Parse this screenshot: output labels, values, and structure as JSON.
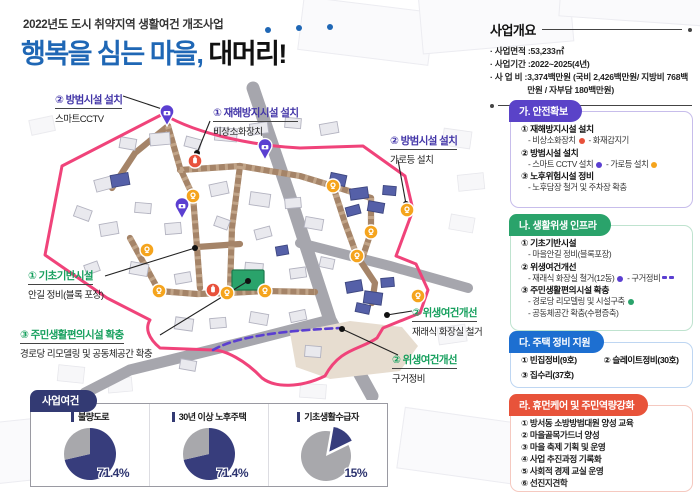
{
  "header": {
    "subtitle": "2022년도 도시 취약지역 생활여건 개조사업",
    "title_blue": "행복을 심는 마을,",
    "title_black": "대머리!"
  },
  "overview": {
    "heading": "사업개요",
    "items": [
      {
        "label": "· 사업면적 : ",
        "value": "53,233㎡"
      },
      {
        "label": "· 사업기간 : ",
        "value": "2022~2025(4년)"
      },
      {
        "label": "· 사 업 비 : ",
        "value": "3,374백만원 (국비 2,426백만원/ 지방비 768백만원 / 자부담 180백만원)"
      }
    ]
  },
  "sections": {
    "ga": {
      "title": "가. 안전확보",
      "items": [
        {
          "head": "① 재해방지시설 설치",
          "subs": [
            "- 비상소화장치",
            "- 화재감지기"
          ]
        },
        {
          "head": "② 방범시설 설치",
          "subs": [
            "- 스마트 CCTV 설치",
            "- 가로등 설치"
          ]
        },
        {
          "head": "③ 노후위험시설 정비",
          "subs": [
            "- 노후담장 철거 및 주차장 확충"
          ]
        }
      ]
    },
    "na": {
      "title": "나. 생활위생 인프라",
      "items": [
        {
          "head": "① 기초기반시설",
          "subs": [
            "- 마을안길 정비(블록포장)"
          ]
        },
        {
          "head": "② 위생여건개선",
          "subs": [
            "- 재래식 화장실 철거(12동)",
            "- 구거정비"
          ]
        },
        {
          "head": "③ 주민생활편의시설 확충",
          "subs": [
            "- 경로당 리모델링 및 시설구축",
            "- 공동체공간 확충(수평증축)"
          ]
        }
      ]
    },
    "da": {
      "title": "다. 주택 정비 지원",
      "items": [
        "① 빈집정비(9호)",
        "② 슬레이트정비(30호)",
        "③ 집수리(37호)"
      ]
    },
    "ra": {
      "title": "라. 휴먼케어 및 주민역량강화",
      "items": [
        "① 방서동 소방방범대원 양성 교육",
        "② 마을골목가드너 양성",
        "③ 마을 축제 기획 및 운영",
        "④ 사업 추진과정 기록화",
        "⑤ 사회적 경제 교실 운영",
        "⑥ 선진지견학"
      ]
    }
  },
  "map": {
    "callouts": [
      {
        "title": "② 방범시설 설치",
        "sub": "스마트CCTV",
        "style": "purple"
      },
      {
        "title": "① 재해방지시설 설치",
        "sub": "비상소화장치",
        "style": "purple"
      },
      {
        "title": "② 방범시설 설치",
        "sub": "가로등 설치",
        "style": "purple"
      },
      {
        "title": "① 기초기반시설",
        "sub": "안길 정비(블록 포장)",
        "style": "green"
      },
      {
        "title": "③ 주민생활편의시설 확충",
        "sub": "경로당 리모델링 및 공동체공간 확충",
        "style": "green"
      },
      {
        "title": "② 위생여건개선",
        "sub": "재래식 화장실 철거",
        "style": "green"
      },
      {
        "title": "② 위생여건개선",
        "sub": "구거정비",
        "style": "green"
      }
    ]
  },
  "conditions": {
    "heading": "사업여건",
    "charts": [
      {
        "label": "불량도로",
        "pct": "71.4%"
      },
      {
        "label": "30년 이상 노후주택",
        "pct": "71.4%"
      },
      {
        "label": "기초생활수급자",
        "pct": "15%"
      }
    ]
  },
  "chart_data": [
    {
      "type": "pie",
      "title": "불량도로",
      "labels": [
        "불량도로",
        "기타"
      ],
      "values": [
        71.4,
        28.6
      ],
      "colors": [
        "#373d7c",
        "#a8a8ac"
      ],
      "start_deg": 0,
      "explode": false,
      "unit": "%"
    },
    {
      "type": "pie",
      "title": "30년 이상 노후주택",
      "labels": [
        "30년 이상 노후주택",
        "기타"
      ],
      "values": [
        71.4,
        28.6
      ],
      "colors": [
        "#373d7c",
        "#a8a8ac"
      ],
      "start_deg": 0,
      "explode": false,
      "unit": "%"
    },
    {
      "type": "pie",
      "title": "기초생활수급자",
      "labels": [
        "기초생활수급자",
        "기타"
      ],
      "values": [
        15,
        85
      ],
      "colors": [
        "#373d7c",
        "#a8a8ac"
      ],
      "start_deg": 10,
      "explode": true,
      "unit": "%"
    }
  ],
  "colors": {
    "title_blue": "#1f67b5",
    "boundary_pink": "#f0437a",
    "card_ga": "#5a43c8",
    "card_na": "#2aa36b",
    "card_da": "#1d6fd1",
    "card_ra": "#e8533a",
    "pie_navy": "#373d7c",
    "pie_gray": "#a8a8ac",
    "marker_fire": "#e8513b",
    "marker_cctv": "#5b3fd1",
    "marker_lamp": "#f5a41d",
    "marker_senior_center": "#2aa36b"
  }
}
